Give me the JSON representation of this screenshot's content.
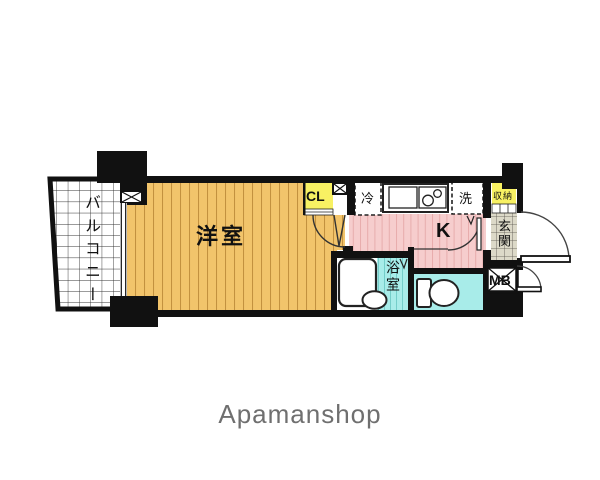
{
  "floorplan": {
    "labels": {
      "balcony": "バルコニー",
      "western_room": "洋室",
      "closet": "CL",
      "refrigerator": "冷",
      "washer": "洗",
      "storage": "収納",
      "kitchen": "K",
      "bathroom": "浴室",
      "entrance": "玄関",
      "meter_box": "MB"
    },
    "colors": {
      "room_orange": "#F2C46B",
      "orange_stripe": "#C3913F",
      "kitchen_pink": "#F6CDCD",
      "pink_stripe": "#E7ACAC",
      "wet_cyan": "#A8ECE9",
      "cyan_stripe": "#74CDC9",
      "closet_yellow": "#F8F163",
      "entrance_tile": "#DCD9C8",
      "wall_black": "#111111",
      "footer_gray": "#6F6F6F"
    }
  },
  "footer": {
    "brand": "Apamanshop"
  }
}
